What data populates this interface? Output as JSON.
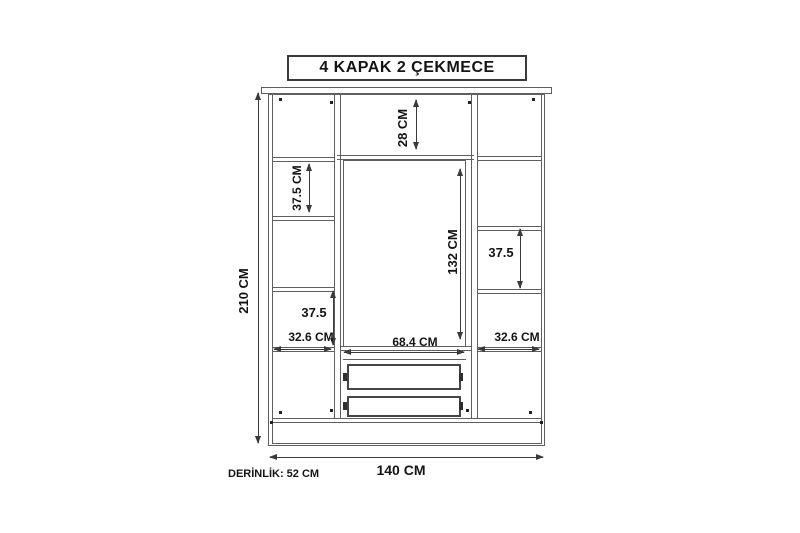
{
  "title": "4 KAPAK 2 ÇEKMECE",
  "wardrobe": {
    "dimensions": {
      "total_height": "210 CM",
      "total_width": "140 CM",
      "depth": "DERİNLİK: 52 CM",
      "top_shelf_height": "28 CM",
      "left_upper_shelf_height": "37.5 CM",
      "center_door_height": "132 CM",
      "right_shelf_height": "37.5",
      "left_lower_shelf_height": "37.5",
      "left_section_width": "32.6 CM",
      "center_section_width": "68.4 CM",
      "right_section_width": "32.6 CM"
    }
  },
  "colors": {
    "background": "#ffffff",
    "line": "#5f5f5f",
    "dimension": "#3a3a3a",
    "text": "#141414"
  }
}
